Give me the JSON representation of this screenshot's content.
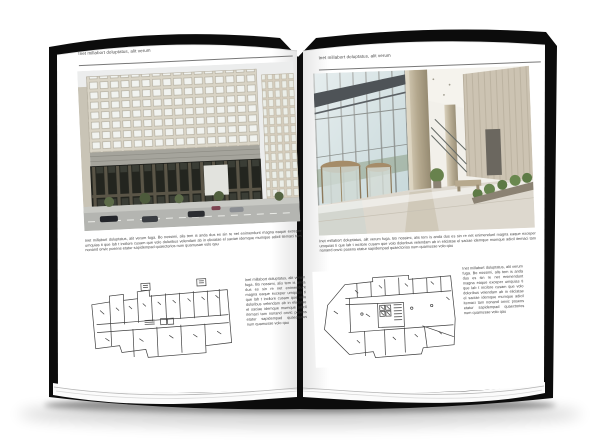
{
  "colors": {
    "cover_black": "#0c0c0c",
    "page_white": "#ffffff",
    "body_text": "#444444",
    "rule_gray": "#787878",
    "facade_beige": "#ddd8cb",
    "glass_dark": "#24251f",
    "lobby_glass_blue": "#c7d8da",
    "plan_line": "#3f3f3f"
  },
  "left_page": {
    "header": "Inet millabort doluptatus, alit verum",
    "photo_name": "office-building-exterior-photo",
    "paragraph": "Inet millabort doluptatus, alit verum fuga. Bo nossimi, alis tem is anda dus es sin re net enimendunt magna eaque exceper umquias ti que lab t incilore cusam que volo doloribus velendam ab in eliciatae el saciae idemque mumque adicil itemaci tam nonand onvic posens etatur sapidempad quaectorios num quamusae volo qau",
    "plan_name": "ground-floor-plan-drawing",
    "side_text": "Inet millabort doluptatus, alit verum fuga. Bo nossimi, alis tem is anda dus es sin re net enimendunt magna eaque exceper umquias ti que lab t incilore cusam que volo doloribus velendam ab in eliciatae el saciae idemque mumque adicil itemaci tam nonand onvic posens etatur sapidempad quaectorios num quamusae volo qau"
  },
  "right_page": {
    "header": "Inet millabort doluptatus, alit verum",
    "photo_name": "lobby-interior-photo",
    "paragraph": "Inet millabort doluptatus, alit verum fuga. Bo nossimi, alis tem is anda dus es sin re net enimendunt magna eaque exceper umquias ti que lab t incilore cusam que volo doloribus velendam ab in eliciatae el saciae idemque mumque adicil itemaci tam nonand onvic posens etatur sapidempad quaectorios num quamusae volo qau",
    "plan_name": "upper-floor-plan-drawing",
    "side_text": "Inet millabort doluptatus, alit verum fuga. Bo nossimi, alis tem is anda dus es sin re net enimendunt magna eaque exceper umquias ti que lab t incilore cusam que volo doloribus velendam ab in eliciatae el saciae idemque mumque adicil itemaci tam nonand onvic posens etatur sapidempad quaectorios num quamusae volo qau"
  }
}
